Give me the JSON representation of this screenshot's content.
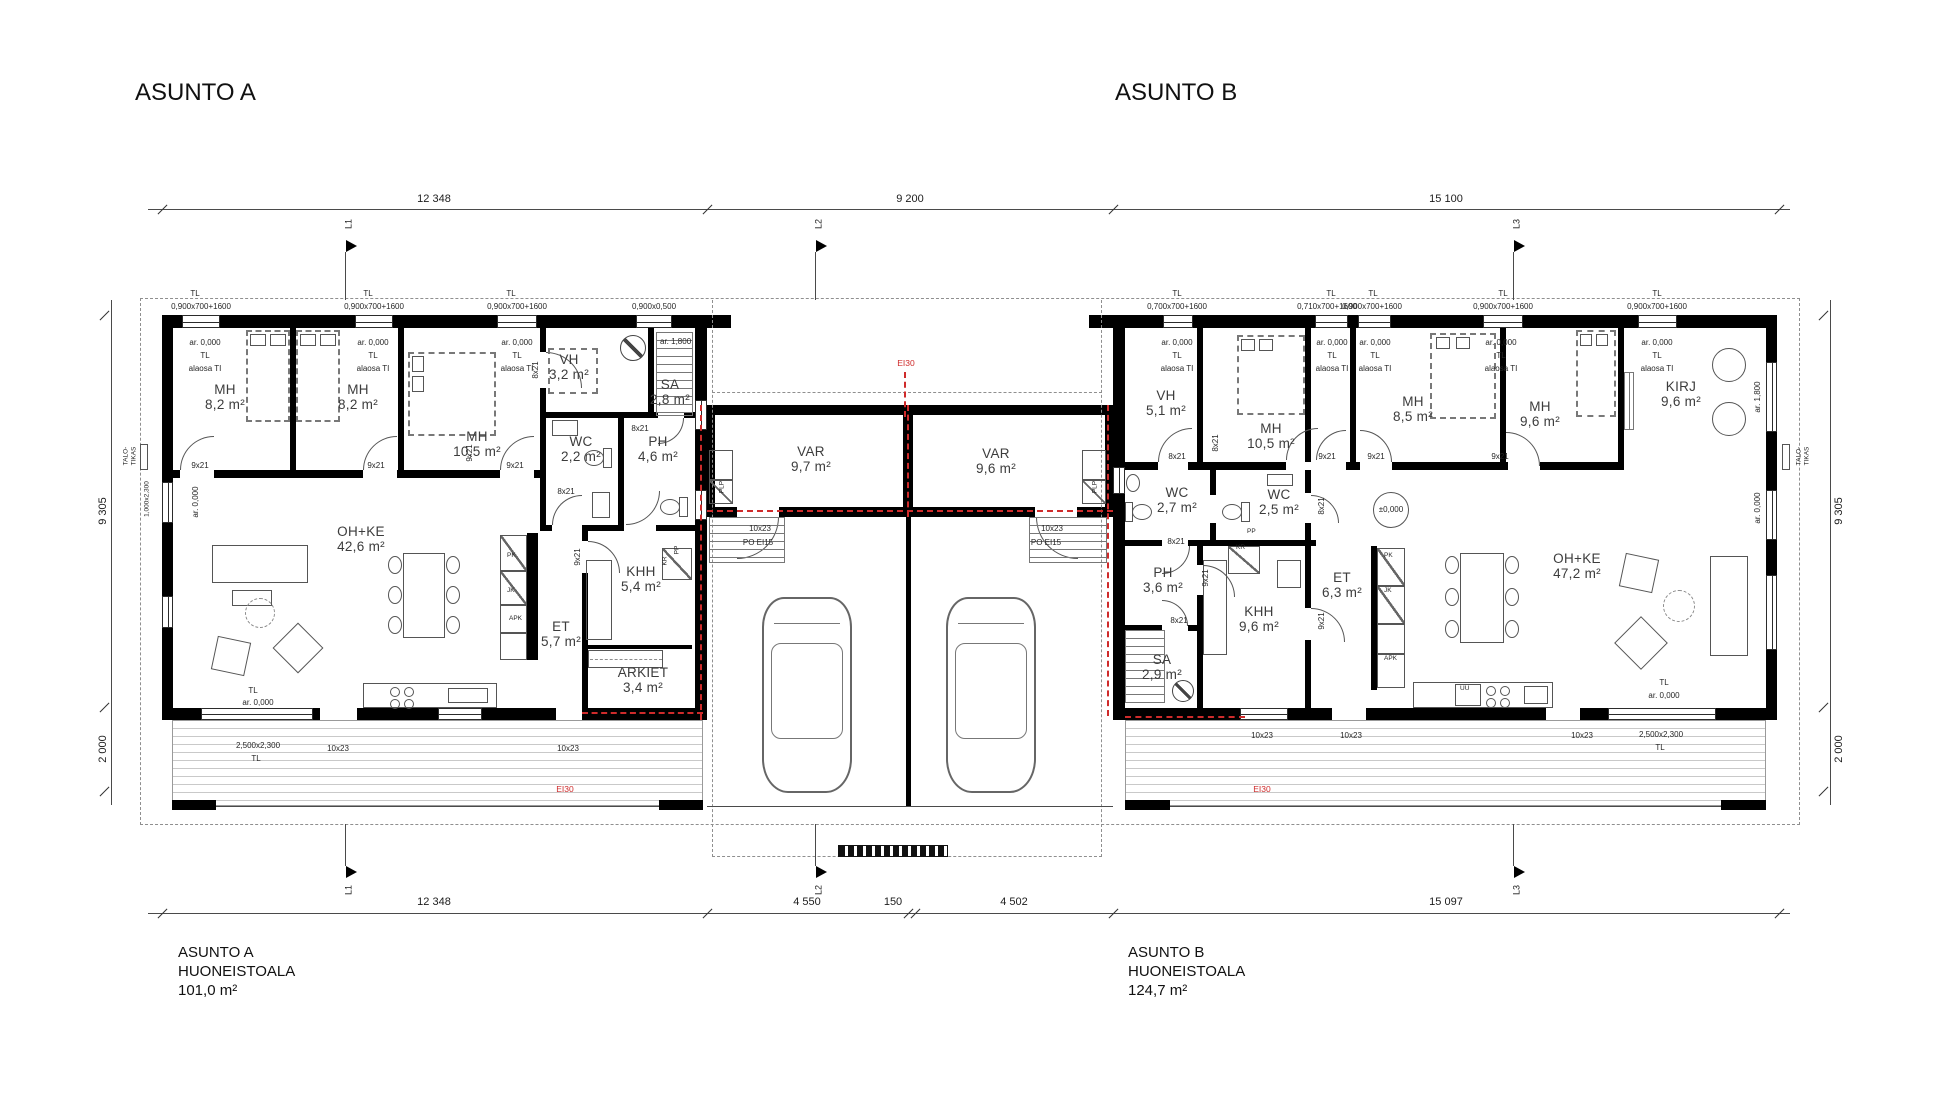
{
  "aptA": {
    "title": "ASUNTO A",
    "area_label": "HUONEISTOALA",
    "area": "101,0 m²",
    "rooms": [
      {
        "n": "MH",
        "a": "8,2 m²"
      },
      {
        "n": "MH",
        "a": "8,2 m²"
      },
      {
        "n": "MH",
        "a": "10,5 m²"
      },
      {
        "n": "VH",
        "a": "3,2 m²"
      },
      {
        "n": "SA",
        "a": "2,8 m²"
      },
      {
        "n": "WC",
        "a": "2,2 m²"
      },
      {
        "n": "PH",
        "a": "4,6 m²"
      },
      {
        "n": "KHH",
        "a": "5,4 m²"
      },
      {
        "n": "ET",
        "a": "5,7 m²"
      },
      {
        "n": "ARKIET",
        "a": "3,4 m²"
      },
      {
        "n": "OH+KE",
        "a": "42,6 m²"
      }
    ]
  },
  "aptB": {
    "title": "ASUNTO B",
    "area_label": "HUONEISTOALA",
    "area": "124,7 m²",
    "rooms": [
      {
        "n": "VH",
        "a": "5,1 m²"
      },
      {
        "n": "MH",
        "a": "10,5 m²"
      },
      {
        "n": "MH",
        "a": "8,5 m²"
      },
      {
        "n": "MH",
        "a": "9,6 m²"
      },
      {
        "n": "KIRJ",
        "a": "9,6 m²"
      },
      {
        "n": "WC",
        "a": "2,7 m²"
      },
      {
        "n": "WC",
        "a": "2,5 m²"
      },
      {
        "n": "PH",
        "a": "3,6 m²"
      },
      {
        "n": "SA",
        "a": "2,9 m²"
      },
      {
        "n": "KHH",
        "a": "9,6 m²"
      },
      {
        "n": "ET",
        "a": "6,3 m²"
      },
      {
        "n": "OH+KE",
        "a": "47,2 m²"
      }
    ]
  },
  "carport": {
    "rooms": [
      {
        "n": "VAR",
        "a": "9,7 m²"
      },
      {
        "n": "VAR",
        "a": "9,6 m²"
      }
    ]
  },
  "dims": {
    "top": [
      "12 348",
      "9 200",
      "15 100"
    ],
    "bottom": [
      "12 348",
      "4 550",
      "150",
      "4 502",
      "15 097"
    ],
    "v1": "9 305",
    "v2": "2 000",
    "axes": [
      "L1",
      "L2",
      "L3"
    ]
  },
  "ann": {
    "tl": "TL",
    "ar0": "ar. 0,000",
    "ar18": "ar. 1,800",
    "alaosa": "alaosa TI",
    "pm0": "±0,000",
    "d8": "8x21",
    "d9": "9x21",
    "d10": "10x23",
    "po": "PO EI15",
    "ei30": "EI30",
    "w900": "0,900x700+1600",
    "w950": "0,900x0,500",
    "w700": "0,700x700+1600",
    "w710": "0,710x700+1600",
    "slider": "2,500x2,300",
    "w1023": "1,000x2,300",
    "pk": "PK",
    "jk": "JK",
    "apk": "APK",
    "pp": "PP",
    "kr": "KR",
    "plp": "PLP",
    "uu": "UU",
    "talo1": "TALO-",
    "talo2": "TIKAS"
  }
}
